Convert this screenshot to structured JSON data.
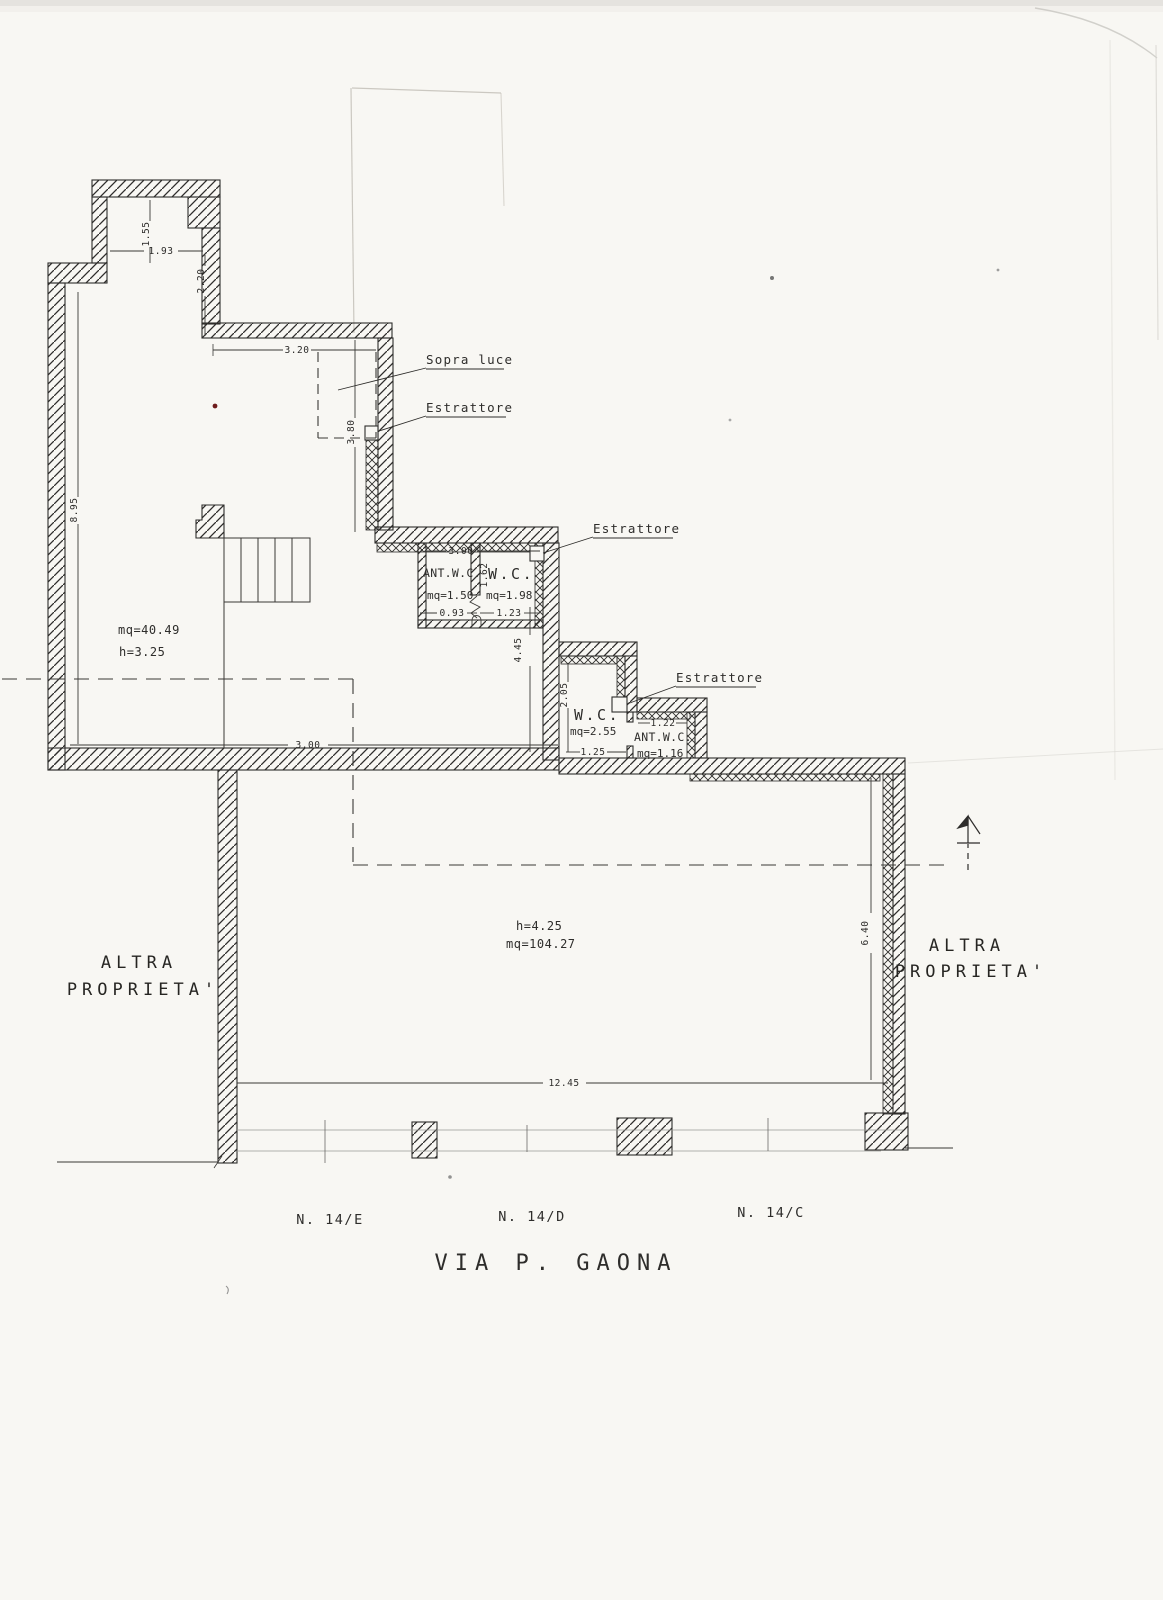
{
  "colors": {
    "ink": "#2e2d2b",
    "paper": "#f8f7f3",
    "dim_line": "#3a3936",
    "faint_street": "#9a9894",
    "accent_dot": "#6e1b1b"
  },
  "icons": {
    "north_arrow_icon": "↑"
  },
  "callouts": {
    "sopra_luce": "Sopra luce",
    "estrattore_corridor": "Estrattore",
    "estrattore_wc1": "Estrattore",
    "estrattore_wc2": "Estrattore"
  },
  "rooms": {
    "main_upper": {
      "area": "mq=40.49",
      "height": "h=3.25"
    },
    "hall": {
      "height": "h=4.25",
      "area": "mq=104.27"
    },
    "ant_wc_1": {
      "name": "ANT.W.C.",
      "area": "mq=1.50"
    },
    "wc_1": {
      "name": "W.C.",
      "area": "mq=1.98"
    },
    "wc_2": {
      "name": "W.C.",
      "area": "mq=2.55"
    },
    "ant_wc_2": {
      "name": "ANT.W.C.",
      "area": "mq=1.16"
    }
  },
  "dimensions": {
    "alcove_height": "1.55",
    "alcove_width": "1.93",
    "alcove_depth": "2.20",
    "skylight_width": "3.20",
    "skylight_depth": "3.80",
    "room_side": "8.95",
    "room_width": "3.00",
    "wc_block_width": "3.00",
    "ant_wc_1_width": "0.93",
    "wc_1_width": "1.23",
    "wc_1_door": "1.62",
    "corridor_drop": "4.45",
    "wc_2_depth": "2.05",
    "wc_2_width": "1.25",
    "ant_wc_2_width": "1.22",
    "right_wall": "6.40",
    "facade_width": "12.45"
  },
  "surroundings": {
    "left_line1": "ALTRA",
    "left_line2": "PROPRIETA'",
    "right_line1": "ALTRA",
    "right_line2": "PROPRIETA'"
  },
  "street": {
    "number_e": "N. 14/E",
    "number_d": "N. 14/D",
    "number_c": "N. 14/C",
    "name": "VIA P. GAONA"
  }
}
